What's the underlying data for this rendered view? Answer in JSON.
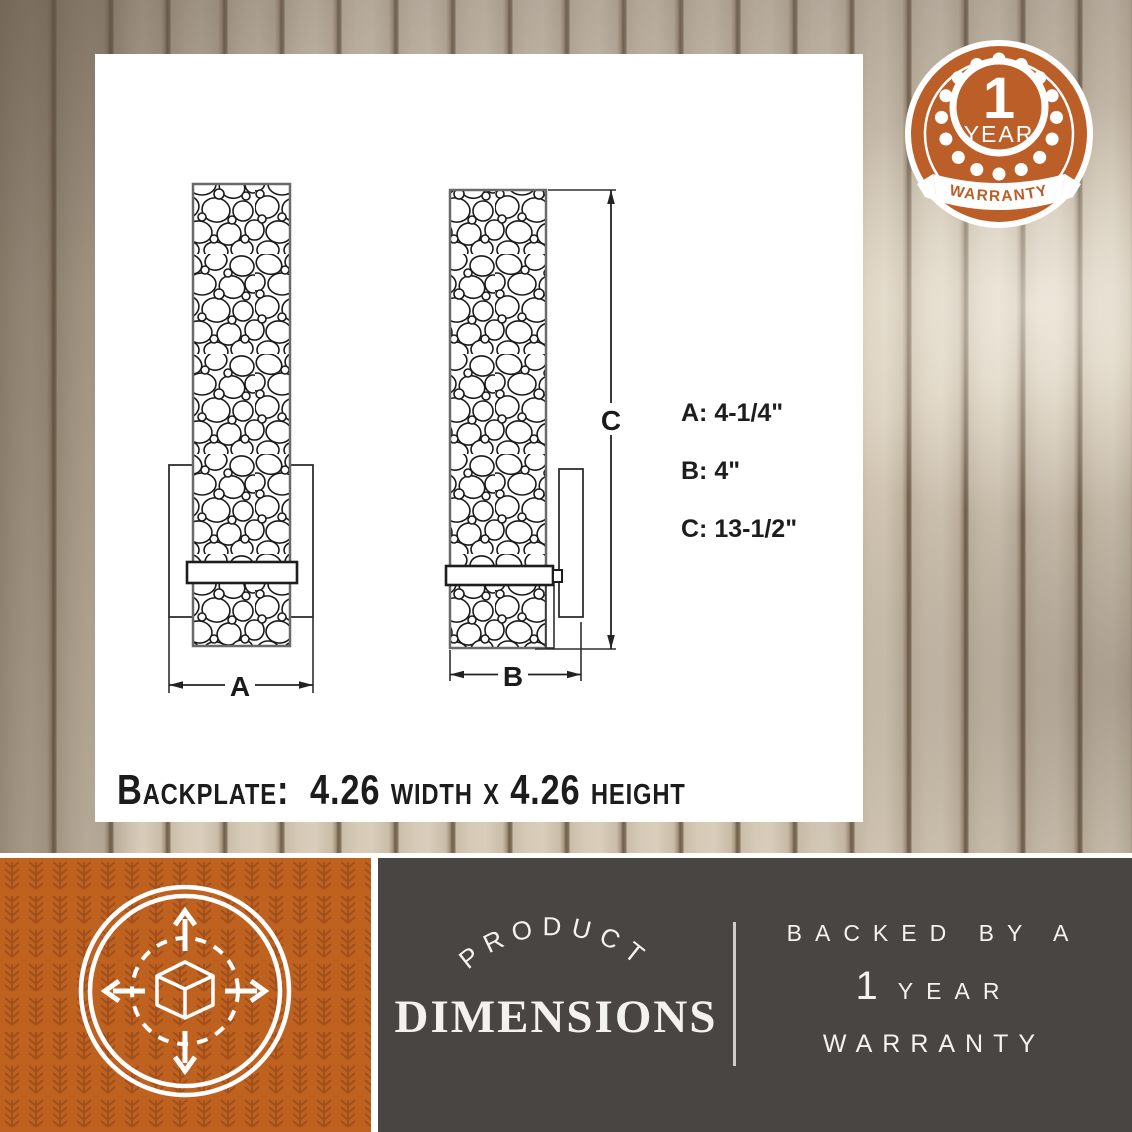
{
  "diagram": {
    "callouts": [
      "A: 4-1/4\"",
      "B: 4\"",
      "C: 13-1/2\""
    ],
    "marker_a": "A",
    "marker_b": "B",
    "marker_c": "C",
    "backplate_note": "Backplate:  4.26 width x 4.26 height"
  },
  "badge": {
    "number": "1",
    "year": "YEAR",
    "warranty": "WARRANTY"
  },
  "footer": {
    "product": "PRODUCT",
    "dimensions": "DIMENSIONS",
    "backed_by": "BACKED BY A",
    "one": "1",
    "year": "YEAR",
    "warranty": "WARRANTY"
  },
  "colors": {
    "orange": "#bf611f",
    "orange_badge": "#bb5e27",
    "wheat_pattern": "#9c4c1a",
    "dark_gray": "#484542",
    "wood_light": "#d9cebb",
    "wood_groove": "#6e5f4c",
    "line_ink": "#222222"
  }
}
